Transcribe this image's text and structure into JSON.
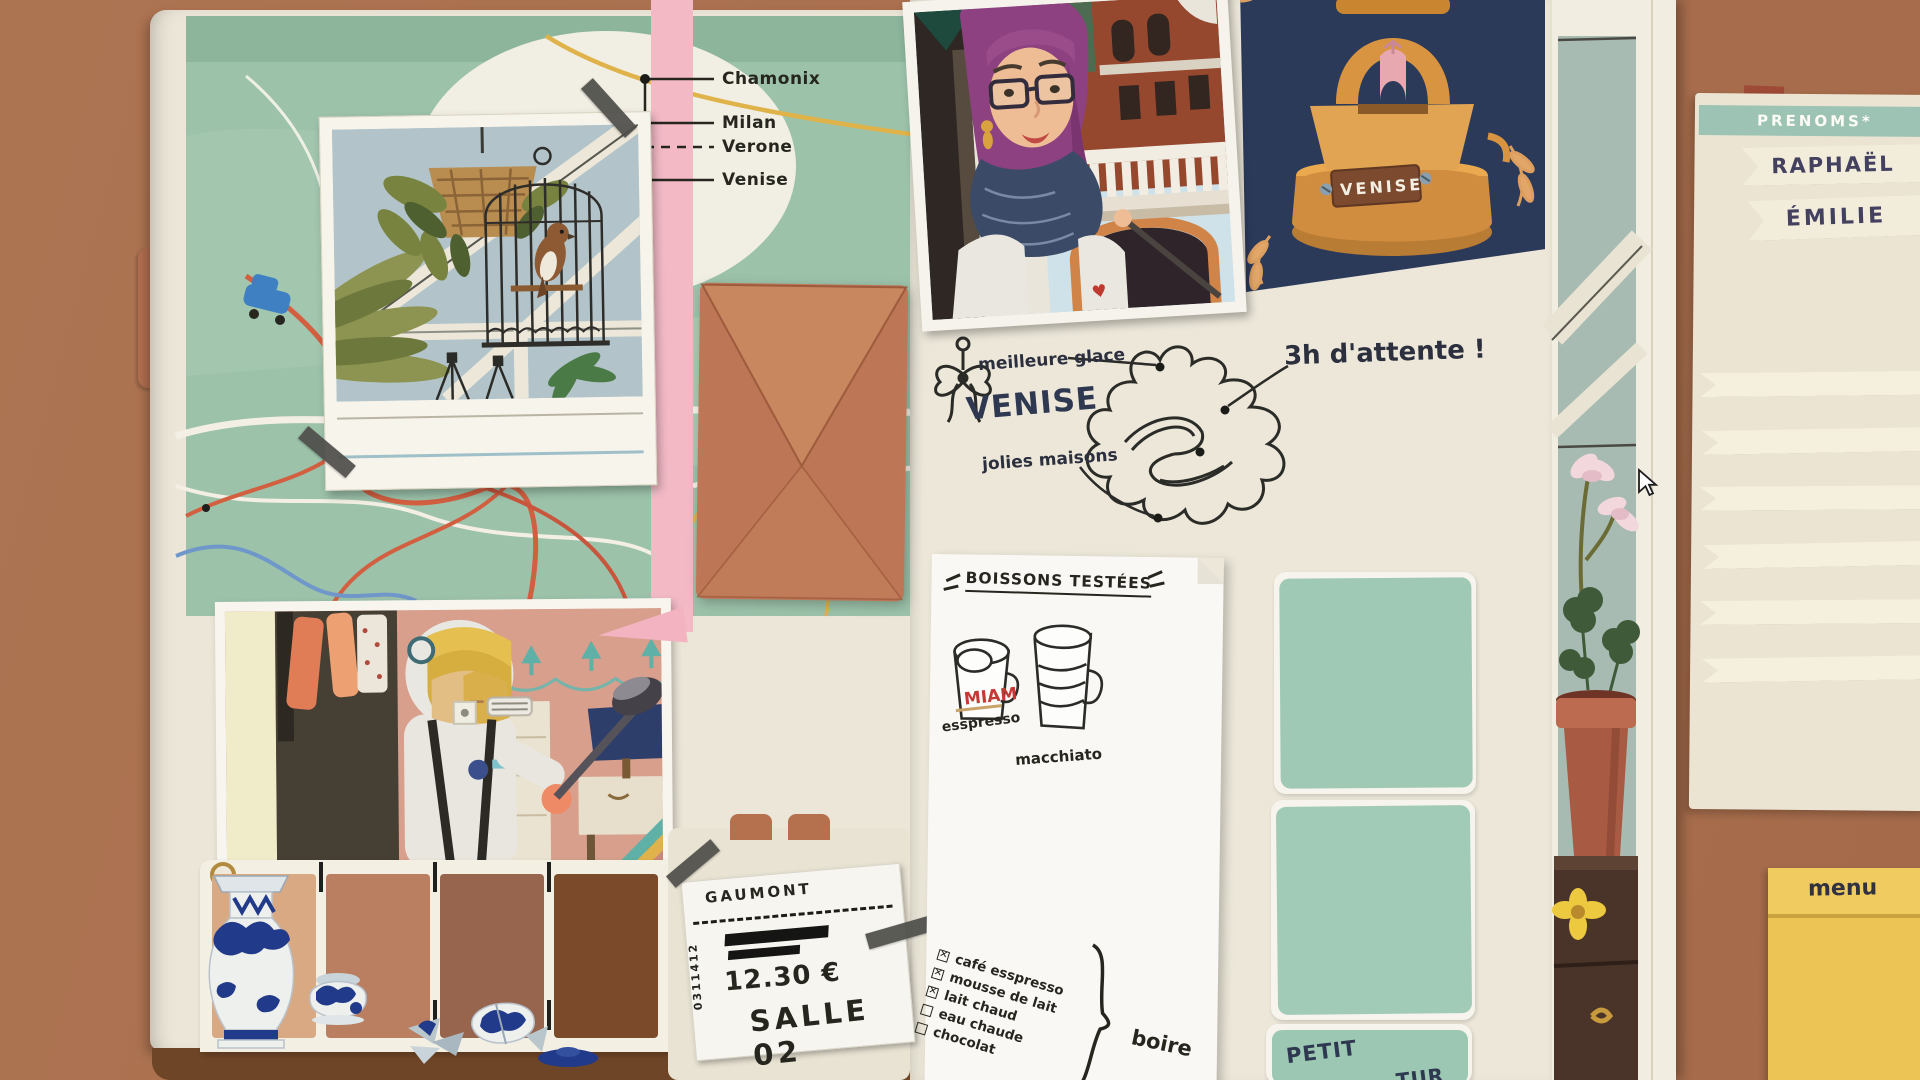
{
  "book": {
    "left_page": {
      "map": {
        "labels": [
          {
            "name": "Chamonix"
          },
          {
            "name": "Milan"
          },
          {
            "name": "Verone"
          },
          {
            "name": "Venise"
          }
        ]
      },
      "ticket": {
        "brand": "GAUMONT",
        "serial": "0311412",
        "price": "12.30 €",
        "room": "SALLE 02"
      }
    },
    "right_page": {
      "postcard": {
        "plaque": "VENISE"
      },
      "venice_sketch": {
        "title": "VENISE",
        "label_top": "meilleure glace",
        "label_bottom": "jolies maisons",
        "label_right": "3h d'attente !"
      },
      "drinks_note": {
        "title": "BOISSONS TESTÉES",
        "drinks": [
          {
            "name": "esspresso",
            "reaction": "MIAM"
          },
          {
            "name": "macchiato"
          }
        ],
        "checklist": [
          {
            "label": "café esspresso",
            "checked": true,
            "mark": "✕"
          },
          {
            "label": "mousse de lait",
            "checked": true,
            "mark": "✕"
          },
          {
            "label": "lait chaud",
            "checked": true,
            "mark": "✕"
          },
          {
            "label": "eau chaude",
            "checked": false,
            "mark": ""
          },
          {
            "label": "chocolat",
            "checked": false,
            "mark": ""
          }
        ],
        "group_label": "boire"
      },
      "swatch_caption_line1": "PETIT",
      "swatch_caption_line2": "TUR"
    }
  },
  "desk": {
    "names_pad": {
      "header": "PRENOMS*",
      "names": [
        "RAPHAËL",
        "ÉMILIE"
      ]
    },
    "sticky_note": {
      "label": "menu"
    }
  },
  "symbols": {
    "heart": "♥"
  },
  "colors": {
    "desk": "#a9714f",
    "page_cream": "#ece6d8",
    "map_green": "#9cc2aa",
    "ribbon_pink": "#f3bac6",
    "envelope_terracotta": "#c07b59",
    "ink": "#26261f",
    "venise_navy": "#2e3850",
    "miam_red": "#c23a33",
    "teal_swatch": "#9fc9b5",
    "pad_header_teal": "#9cc3b4",
    "sticky_yellow": "#ebc455",
    "porcelain_navy": "#223a8a",
    "brown_swatches": [
      "#d8a983",
      "#ba7e61",
      "#97654e",
      "#7b4a2b"
    ]
  }
}
